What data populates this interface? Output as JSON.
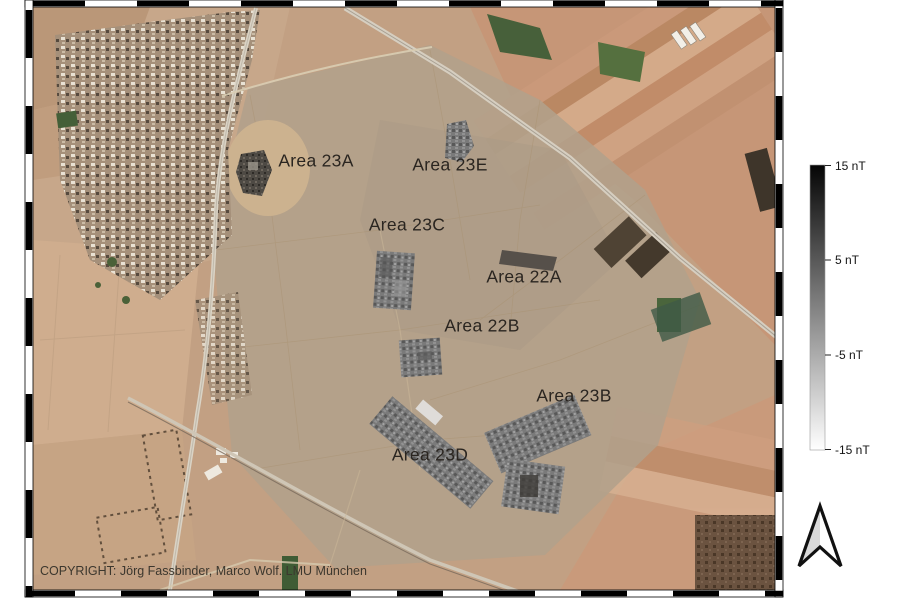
{
  "figure": {
    "copyright": "COPYRIGHT: Jörg Fassbinder, Marco Wolf. LMU München"
  },
  "map": {
    "area_labels": [
      {
        "text": "Area 23A"
      },
      {
        "text": "Area 23E"
      },
      {
        "text": "Area 23C"
      },
      {
        "text": "Area 22A"
      },
      {
        "text": "Area 22B"
      },
      {
        "text": "Area 23B"
      },
      {
        "text": "Area 23D"
      }
    ]
  },
  "colorbar": {
    "unit": "nT",
    "tick_labels": [
      "15 nT",
      "5 nT",
      "-5 nT",
      "-15 nT"
    ],
    "gradient_top": "#000000",
    "gradient_bottom": "#ffffff"
  }
}
